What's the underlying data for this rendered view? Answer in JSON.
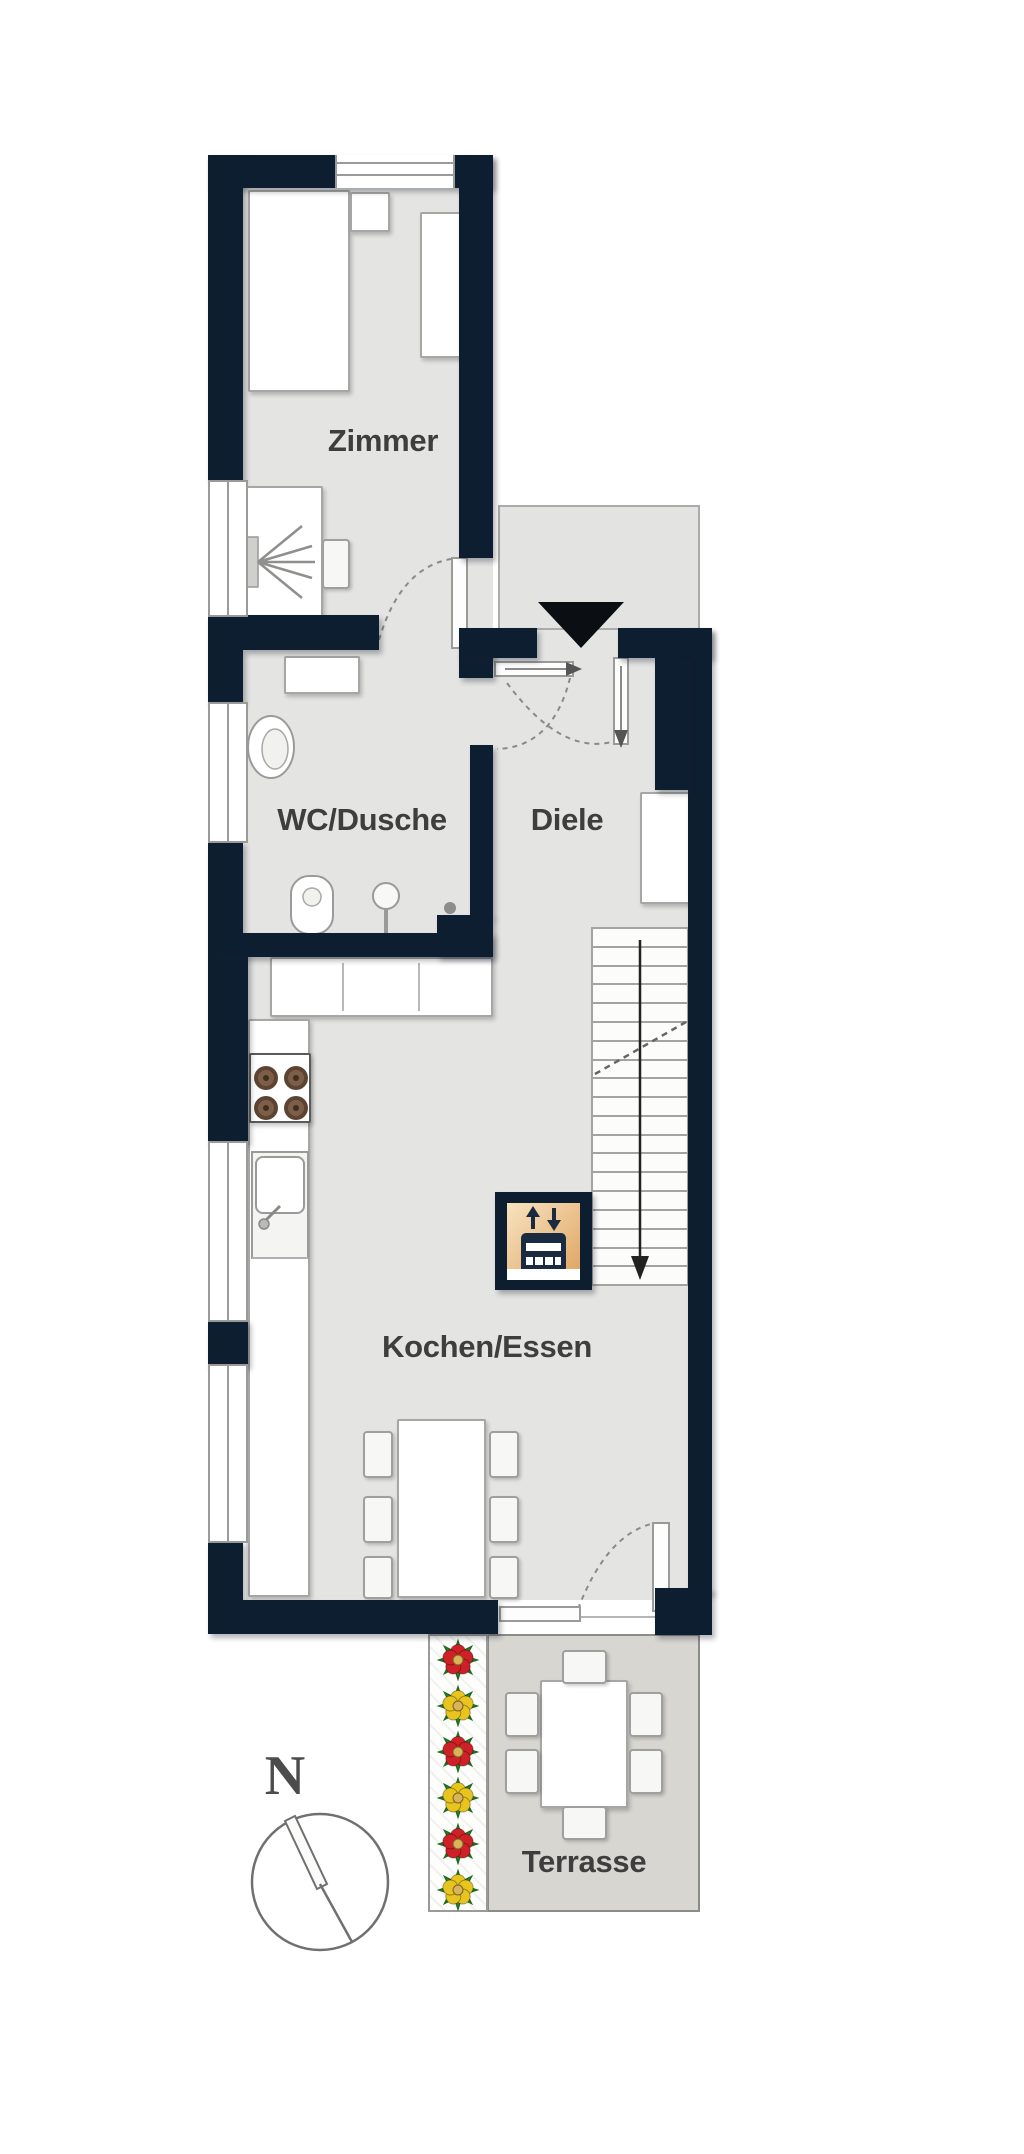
{
  "plan": {
    "type": "floor-plan",
    "rooms": {
      "zimmer": "Zimmer",
      "wc_dusche": "WC/Dusche",
      "diele": "Diele",
      "kochen_essen": "Kochen/Essen",
      "terrasse": "Terrasse"
    },
    "compass_north": "N",
    "markers": {
      "entrance": "entrance-arrow",
      "stairs_direction": "down",
      "appliance": "oven-stacked-icon"
    }
  },
  "colors": {
    "wall": "#0e1e31",
    "floor": "#e4e5e3",
    "terrace-floor": "#d8d6d1",
    "landing-floor": "#e3e4e2",
    "oven-tan-light": "#f8e3c0",
    "oven-tan-dark": "#dfa35f",
    "flower-red": "#cf2027",
    "flower-yellow": "#e8c51e",
    "leaf-green": "#2f8f2c",
    "line-gray": "#9a9a98",
    "label-text": "#3e3e3e"
  }
}
